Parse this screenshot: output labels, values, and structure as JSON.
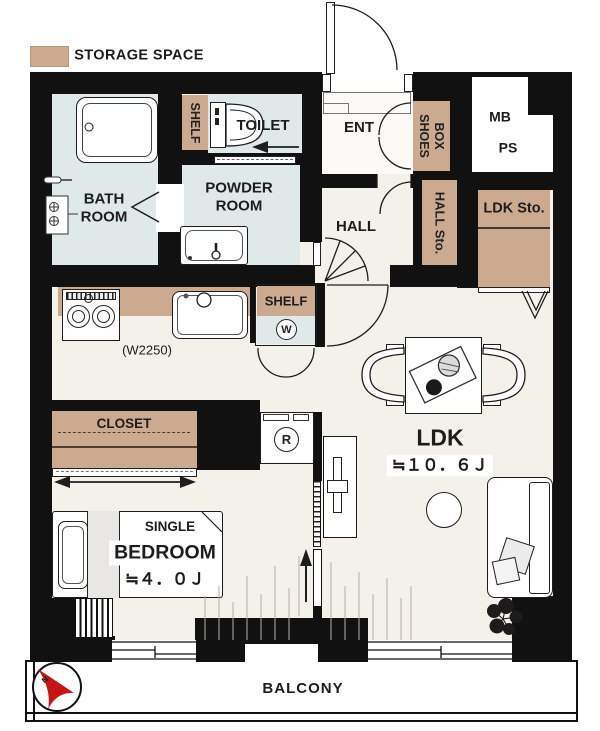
{
  "legend": {
    "label": "STORAGE SPACE"
  },
  "colors": {
    "storage_tan": "#cbaa90",
    "wet_room_blue": "#e0e9ea",
    "floor": "#f4f1ea",
    "wall_black": "#111111",
    "north_arrow_red": "#c81414"
  },
  "rooms": {
    "bathroom": {
      "label": "BATH\nROOM"
    },
    "powder_room": {
      "label": "POWDER\nROOM"
    },
    "toilet": {
      "label": "TOILET"
    },
    "entrance": {
      "label": "ENT"
    },
    "hall": {
      "label": "HALL"
    },
    "ldk": {
      "label": "LDK",
      "size": "≒１０．６Ｊ"
    },
    "bedroom": {
      "label": "BEDROOM",
      "size": "≒４．０Ｊ",
      "bed_type": "SINGLE"
    },
    "balcony": {
      "label": "BALCONY"
    }
  },
  "storage": {
    "toilet_shelf": {
      "label": "SHELF"
    },
    "shoes_box": {
      "line1": "SHOES",
      "line2": "BOX"
    },
    "hall_storage": {
      "label": "HALL Sto."
    },
    "ldk_storage": {
      "label": "LDK Sto."
    },
    "closet": {
      "label": "CLOSET"
    },
    "kitchen_shelf": {
      "label": "SHELF"
    }
  },
  "fixtures": {
    "washing_machine": {
      "label": "W"
    },
    "refrigerator": {
      "label": "R"
    },
    "kitchen_counter_width": {
      "label": "(W2250)"
    },
    "meter_box": {
      "label": "MB"
    },
    "pipe_space": {
      "label": "PS"
    }
  },
  "compass": {
    "label": "N"
  }
}
